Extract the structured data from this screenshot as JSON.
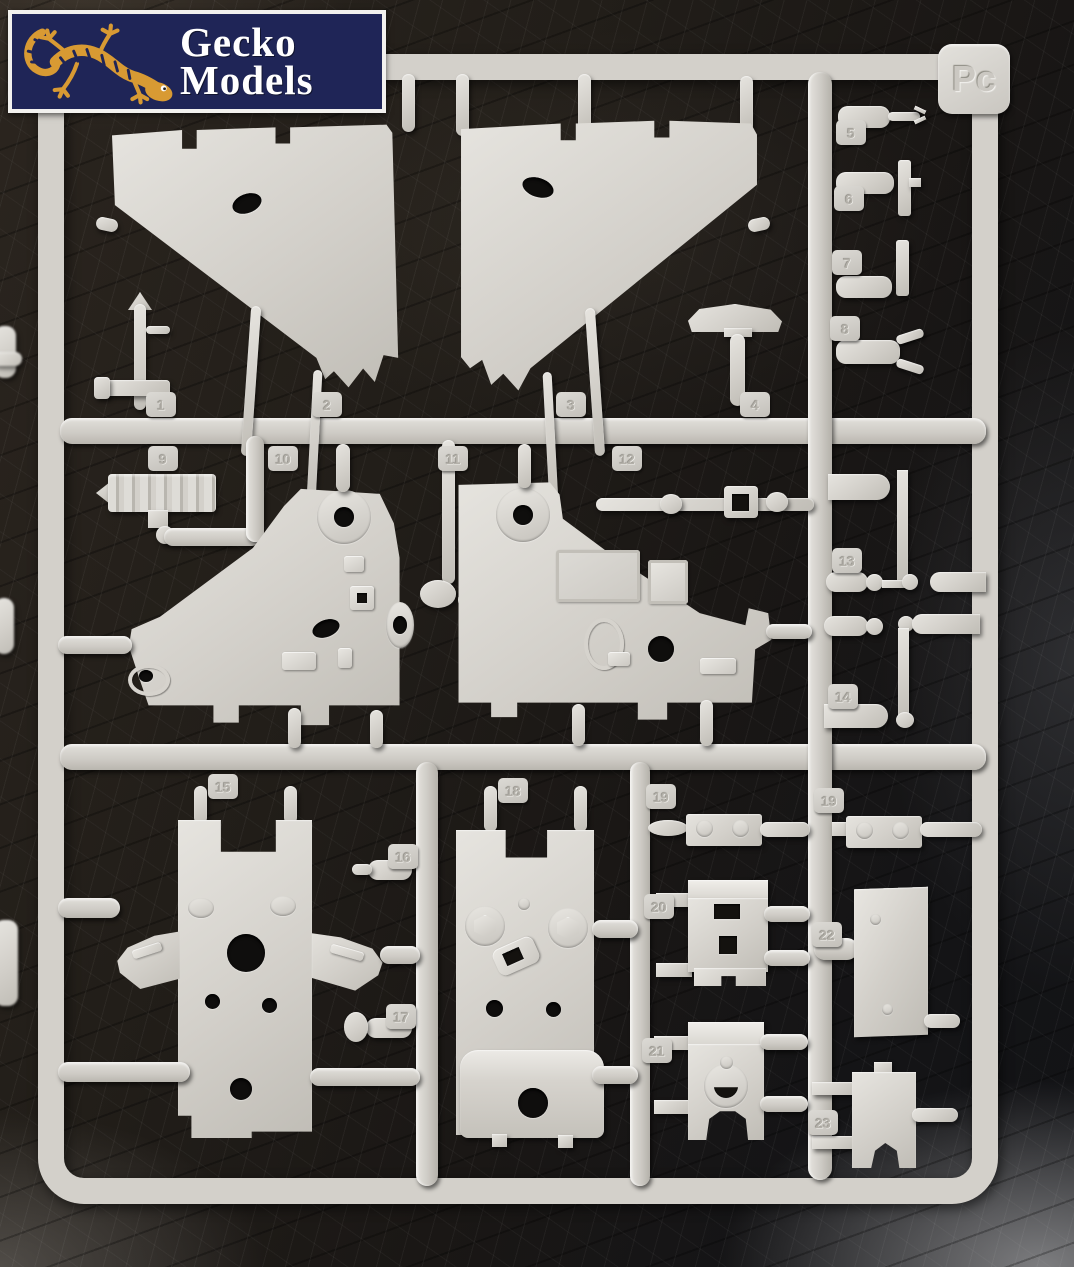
{
  "logo": {
    "line1": "Gecko",
    "line2": "Models"
  },
  "sprue": {
    "label": "Pc",
    "part_tags": [
      "1",
      "2",
      "3",
      "4",
      "5",
      "6",
      "7",
      "8",
      "9",
      "10",
      "11",
      "12",
      "13",
      "14",
      "15",
      "16",
      "17",
      "18",
      "19",
      "19",
      "20",
      "21",
      "22",
      "23"
    ]
  },
  "colors": {
    "plastic": "#d3d0ca",
    "plastic_highlight": "#e6e4df",
    "plastic_shadow": "#b4b1aa",
    "leather": "#1a1715",
    "logo_background": "#1f2557",
    "logo_border": "#f2f1ee",
    "gecko_orange": "#d89a33",
    "hole_dark": "#0f0e0d"
  }
}
